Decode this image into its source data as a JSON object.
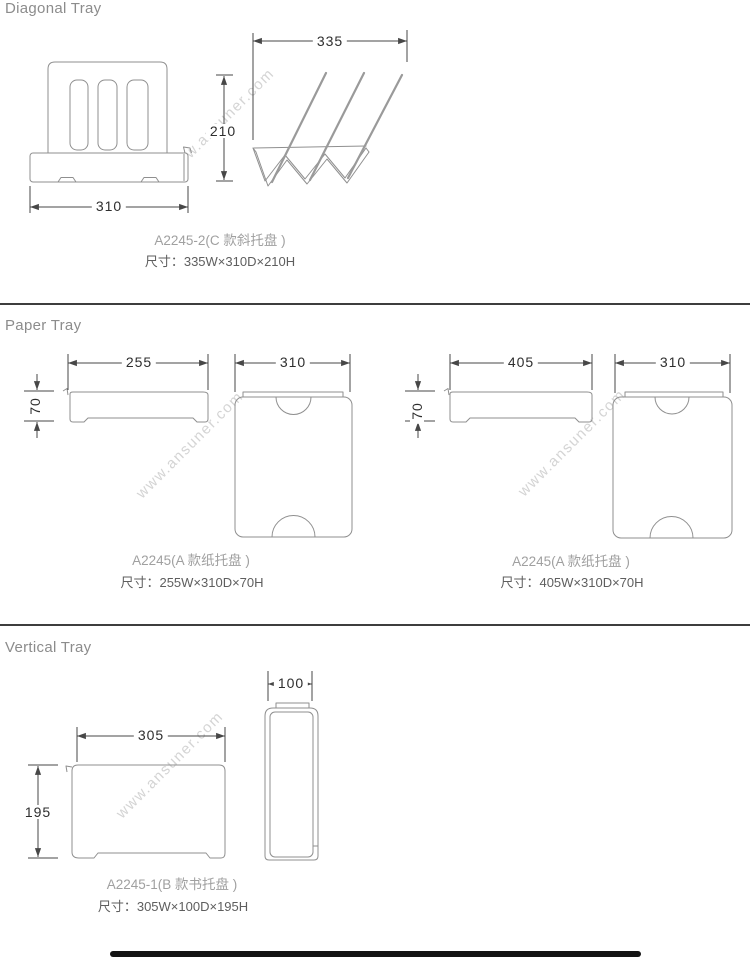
{
  "watermark": {
    "text": "www.ansuner.com"
  },
  "sections": {
    "diagonal": {
      "title": "Diagonal Tray",
      "model": "A2245-2(C 款斜托盘 )",
      "size": "尺寸：335W×310D×210H",
      "dims": {
        "side_width": "335",
        "height": "210",
        "front_width": "310"
      }
    },
    "paper": {
      "title": "Paper Tray",
      "left": {
        "model": "A2245(A 款纸托盘 )",
        "size": "尺寸：255W×310D×70H",
        "dims": {
          "width": "255",
          "height": "70",
          "depth": "310"
        }
      },
      "right": {
        "model": "A2245(A 款纸托盘 )",
        "size": "尺寸：405W×310D×70H",
        "dims": {
          "width": "405",
          "height": "70",
          "depth": "310"
        }
      }
    },
    "vertical": {
      "title": "Vertical Tray",
      "model": "A2245-1(B 款书托盘 )",
      "size": "尺寸：305W×100D×195H",
      "dims": {
        "width": "305",
        "height": "195",
        "depth": "100"
      }
    }
  }
}
